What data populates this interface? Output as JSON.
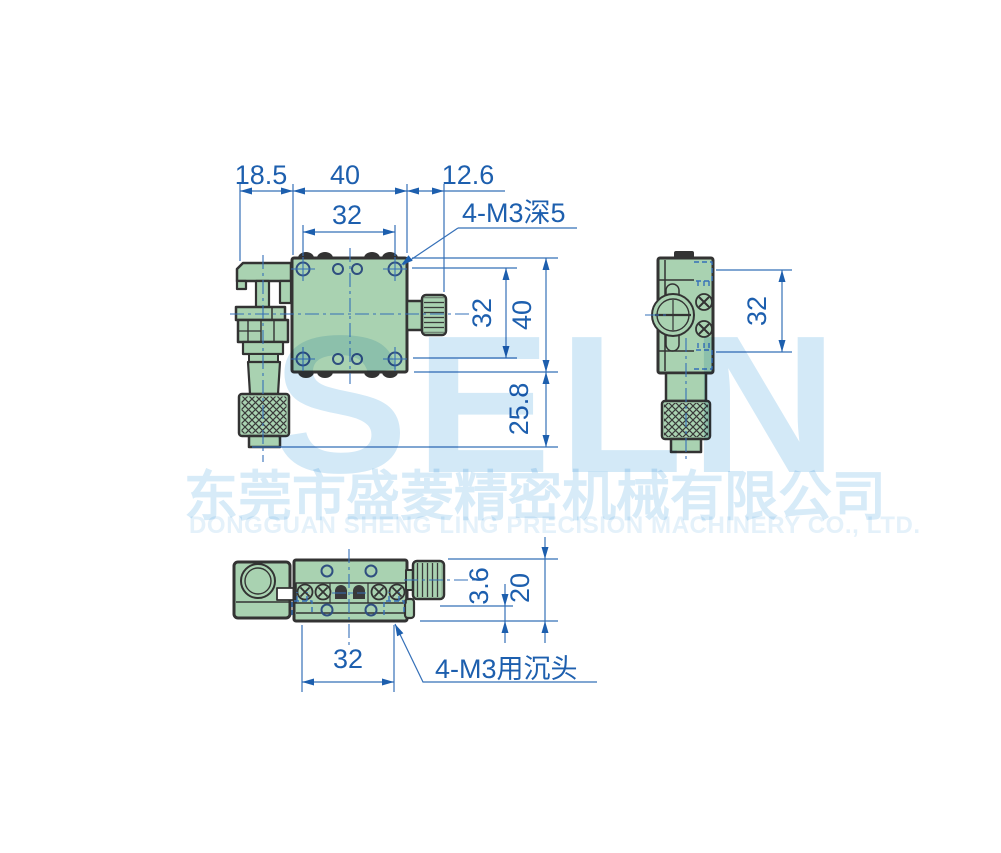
{
  "dims": {
    "front": {
      "overhang": "18.5",
      "width": "40",
      "knob": "12.6",
      "hole_pitch_x": "32",
      "hole_pitch_y": "32",
      "height": "40",
      "micrometer": "25.8",
      "thread_note": "4-M3深5"
    },
    "side": {
      "hole_pitch": "32"
    },
    "bottom": {
      "hole_pitch": "32",
      "step": "3.6",
      "height": "20",
      "counterbore_note": "4-M3用沉头"
    }
  },
  "watermark": {
    "logo": "SELN",
    "company_cn": "东莞市盛菱精密机械有限公司",
    "company_en": "DONGGUAN SHENG LING PRECISION MACHINERY CO., LTD."
  },
  "colors": {
    "dimension_blue": "#1d5fae",
    "line_blue": "#3570b8",
    "body_green": "#a9d2b1",
    "outline_dark": "#333333",
    "hole_ring_blue": "#2f4f80",
    "watermark_blue": "#d3e9f7"
  }
}
